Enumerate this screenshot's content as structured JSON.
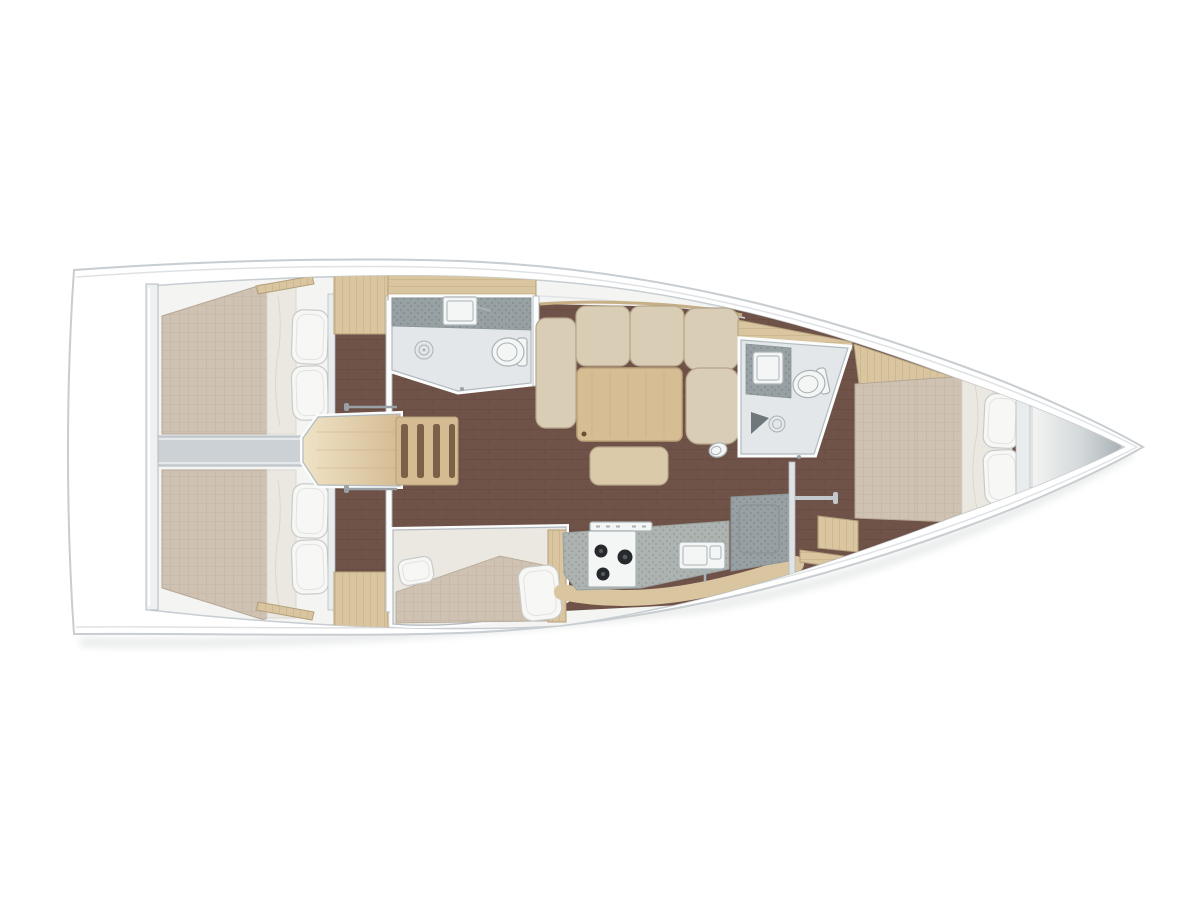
{
  "meta": {
    "title": "Sailing yacht interior layout — top-view floor plan",
    "diagram_type": "boat-floorplan",
    "orientation": "bow pointing right, stern at left"
  },
  "parts": [
    {
      "name": "aft-cabin-top",
      "label": "Aft double cabin (port)"
    },
    {
      "name": "aft-cabin-bottom",
      "label": "Aft double cabin (starboard)"
    },
    {
      "name": "companionway",
      "label": "Companionway steps"
    },
    {
      "name": "aft-head",
      "label": "Aft head with shower, sink and toilet"
    },
    {
      "name": "salon",
      "label": "Salon with L-sofa, table and stool"
    },
    {
      "name": "settee-berth",
      "label": "Salon settee berth with pillows"
    },
    {
      "name": "galley",
      "label": "Galley with stove, double sink and fridge"
    },
    {
      "name": "forward-head",
      "label": "Forward head with shower, sink and toilet"
    },
    {
      "name": "forward-cabin",
      "label": "Forward master cabin"
    },
    {
      "name": "bow-locker",
      "label": "Bow anchor locker"
    }
  ],
  "palette": {
    "page_bg": "#ffffff",
    "hull_fill": "#ffffff",
    "hull_stroke": "#c7cdd1",
    "hull_shadow": "#dfe2e4",
    "deck_fill": "#f4f4f3",
    "wall_white": "#fbfcfc",
    "wall_gray": "#b3bac0",
    "floor_wood": "#705348",
    "floor_line": "#61483e",
    "wood": "#d9c6a1",
    "wood_line": "#c6af85",
    "wood_stroke": "#b3a07c",
    "mattress": "#cfc2b2",
    "mattress_line": "#bfb1a0",
    "mattress_stroke": "#b5a795",
    "linen": "#ebe8e2",
    "linen_line": "#d5d2cb",
    "pillow": "#f7f7f5",
    "pillow_stroke": "#c9cbca",
    "sofa": "#d9cdb6",
    "sofa_line": "#b5a68c",
    "table_wood": "#d7bd94",
    "table_line": "#bda379",
    "stool": "#dbcaa9",
    "counter": "#adb3b0",
    "counter_dot": "#929995",
    "counter_dark": "#97a0a3",
    "counter_dark_dot": "#7e888b",
    "fixture": "#f4f6f6",
    "fixture_stroke": "#a9b2b6",
    "head_floor": "#e3e7e9",
    "divider": "#cbd1d5",
    "stair_wood": "#d5bb92",
    "stair_light": "#efe3c6",
    "stair_slot": "#7b6147",
    "burner": "#26292c",
    "rail_gray": "#99a1a6",
    "bow_gray": "#a9b1b6",
    "headboard": "#e9eced"
  }
}
